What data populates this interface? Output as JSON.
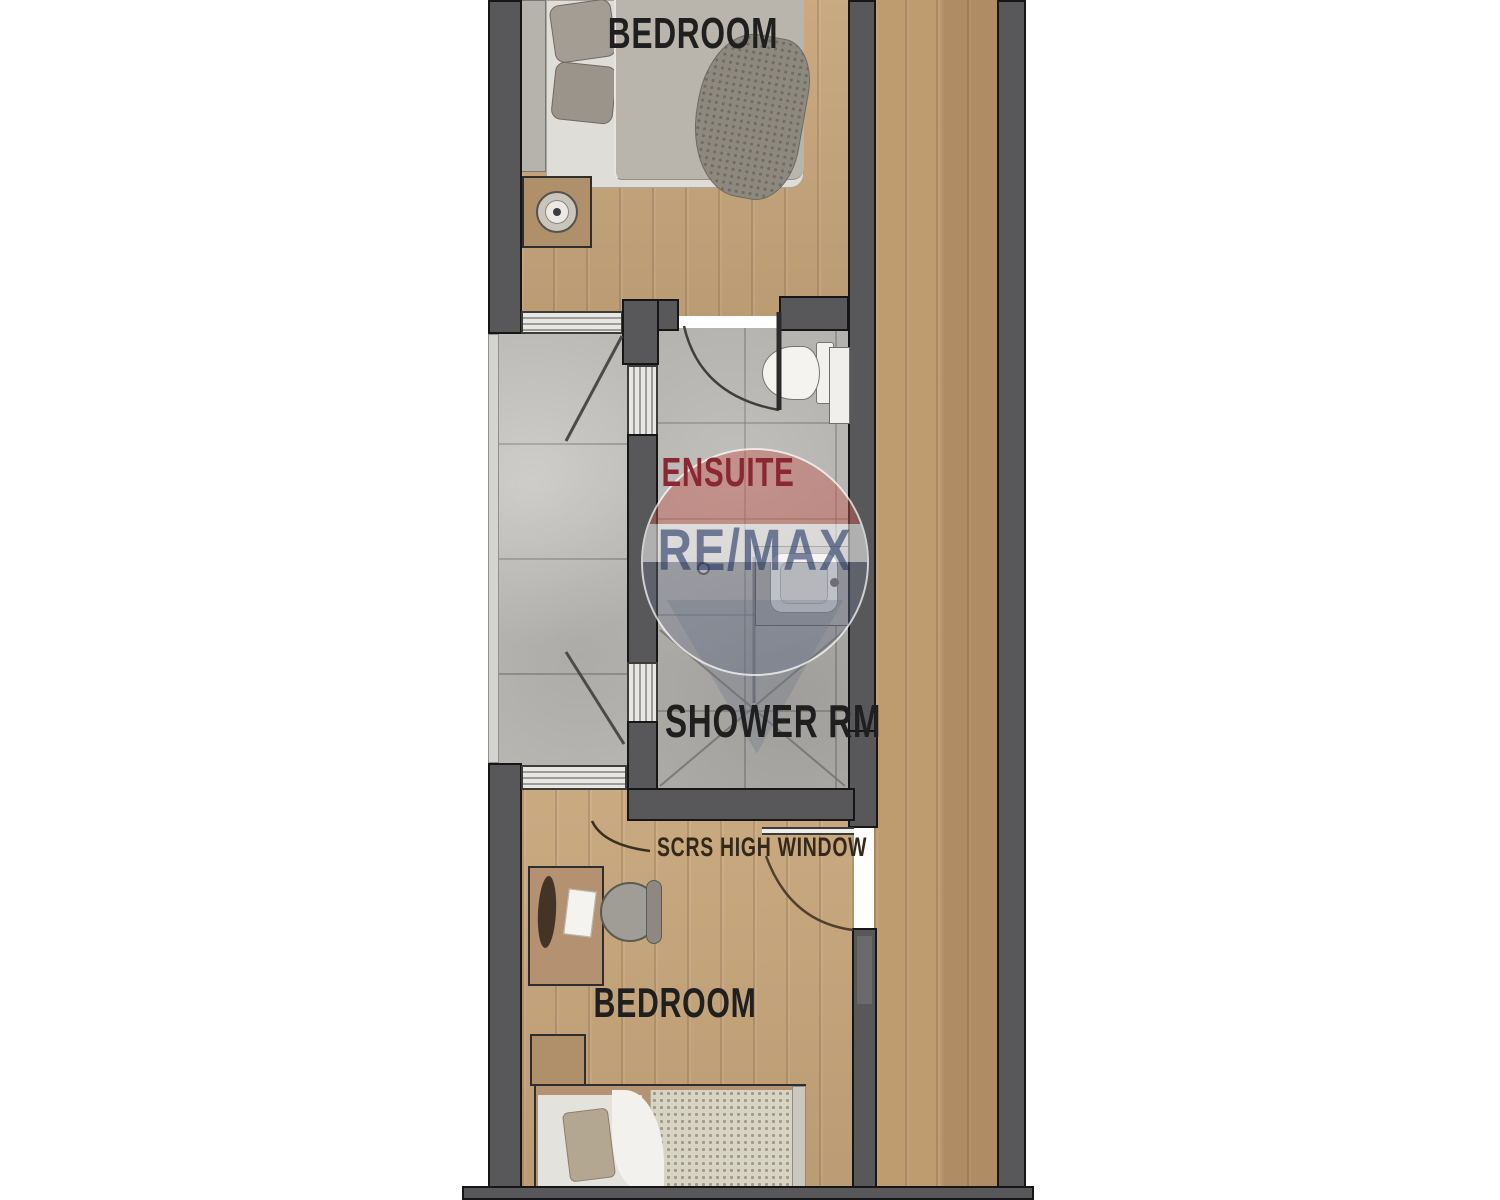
{
  "plan": {
    "rooms": {
      "bedroom_top_label": "BEDROOM",
      "ensuite_label": "ENSUITE",
      "shower_label": "SHOWER RM",
      "bedroom_bottom_label": "BEDROOM",
      "window_note": "SCRS HIGH WINDOW"
    },
    "watermark": {
      "brand": "RE/MAX"
    },
    "colors": {
      "wall": "#58585a",
      "wall_outline": "#161616",
      "wood_floor": "#c7a57a",
      "corridor_floor": "#bf9b70",
      "tile_landing": "#bcbab6",
      "tile_bathroom": "#b1afab",
      "ensuite_text": "#8b2733",
      "label_text": "#1f1f1f",
      "note_text": "#33281a",
      "watermark_text": "#1c3060",
      "watermark_red": "#c25a50",
      "watermark_blue_gray": "#6c7488",
      "fixture_white": "#f2f1ee"
    }
  }
}
